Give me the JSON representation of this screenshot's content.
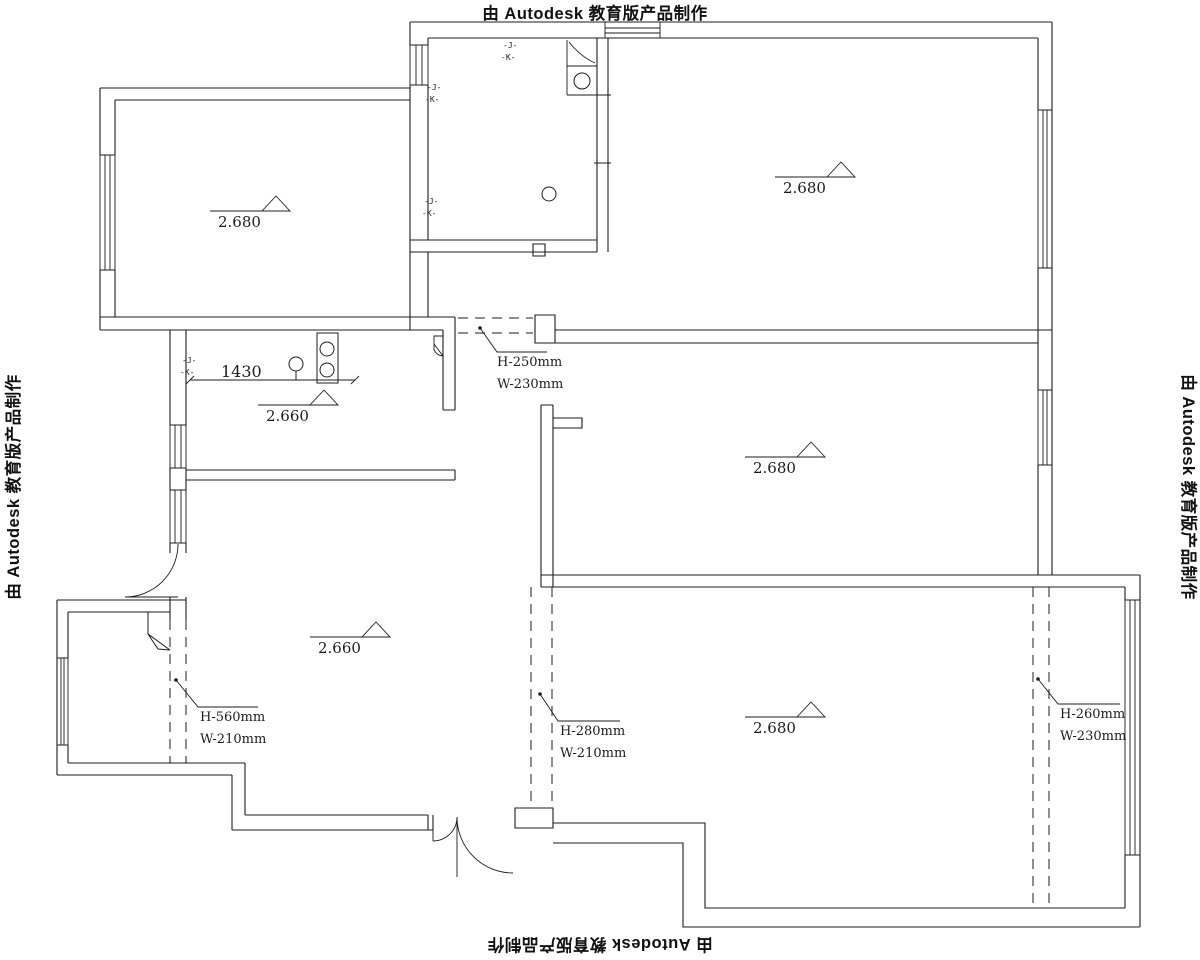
{
  "credit": {
    "text": "由 Autodesk 教育版产品制作"
  },
  "levels": {
    "room_top_left": "2.680",
    "room_top_right": "2.680",
    "room_mid_right": "2.680",
    "room_bottom_right": "2.680",
    "kitchen": "2.660",
    "living": "2.660"
  },
  "beams": {
    "passage": {
      "h": "H-250mm",
      "w": "W-230mm"
    },
    "balcony": {
      "h": "H-560mm",
      "w": "W-210mm"
    },
    "living_bedroom": {
      "h": "H-280mm",
      "w": "W-210mm"
    },
    "bedroom_right": {
      "h": "H-260mm",
      "w": "W-230mm"
    }
  },
  "dimensions": {
    "kitchen_counter": "1430"
  },
  "micro_marks": {
    "line1": "-J-",
    "line2": "-K-"
  },
  "colors": {
    "line": "#1c1c1c",
    "background": "#ffffff"
  }
}
